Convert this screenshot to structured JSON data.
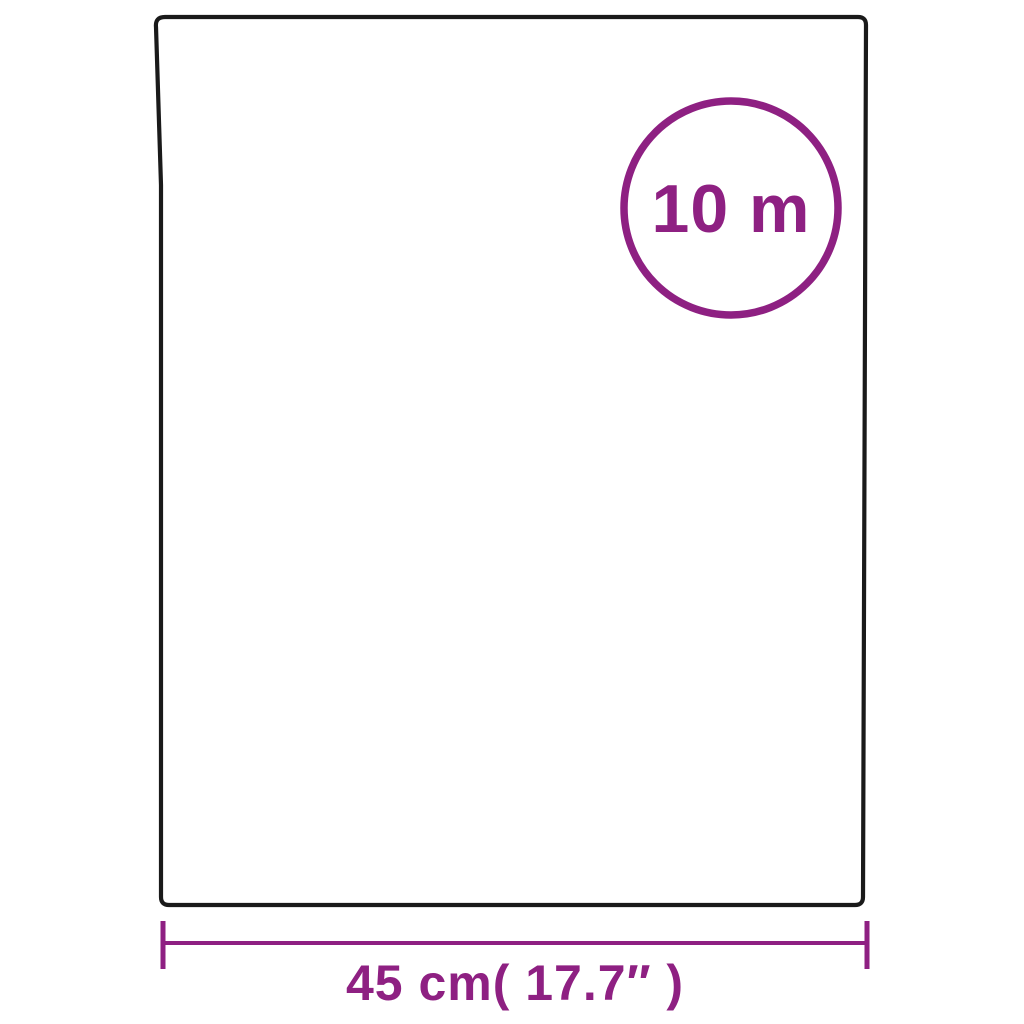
{
  "diagram": {
    "type": "product-size-diagram",
    "length_badge": {
      "text": "10 m"
    },
    "width_dimension": {
      "text": "45 cm( 17.7″ )"
    },
    "colors": {
      "accent": "#8e2082",
      "outline": "#1a1a1a",
      "background": "#ffffff"
    }
  }
}
